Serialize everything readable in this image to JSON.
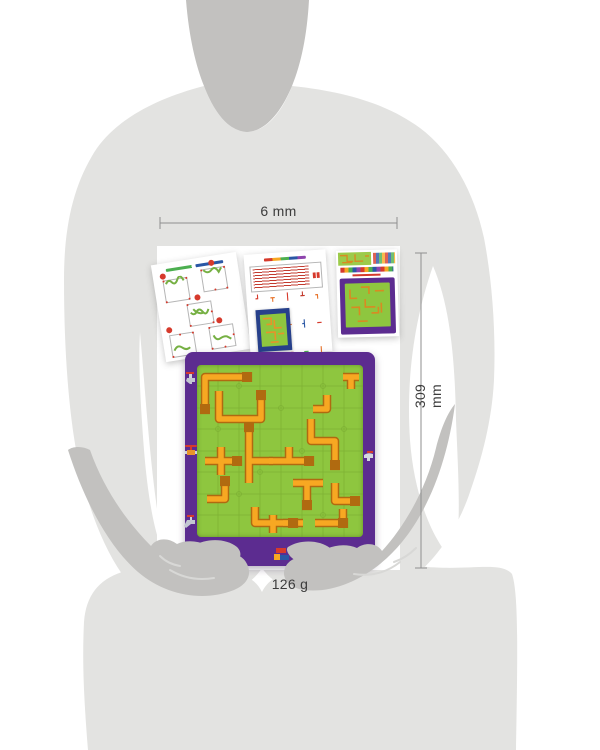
{
  "annotations": {
    "width": "6 mm",
    "height": "309 mm",
    "weight": "126 g"
  },
  "scene": {
    "description_elements": [
      "person-silhouette",
      "solutions-sheet",
      "instructions-sheet",
      "package-card",
      "pipe-maze-game-board"
    ]
  },
  "board": {
    "left_edge_icons": [
      "faucet",
      "valve",
      "faucet"
    ],
    "right_edge_icons": [
      "faucet"
    ],
    "bottom_mark": "brand-logo"
  },
  "colors": {
    "board_frame": "#5c2c90",
    "board_field": "#8ec63f",
    "pipe_fill": "#f7a822",
    "pipe_outline": "#b06a10",
    "accent_red": "#d63a2c",
    "accent_blue": "#2a57a5",
    "silhouette_light": "#e3e3e1",
    "silhouette_dark": "#c2c1bf",
    "dimension_line": "#8f8f8f",
    "photo_background": "#ffffff"
  }
}
